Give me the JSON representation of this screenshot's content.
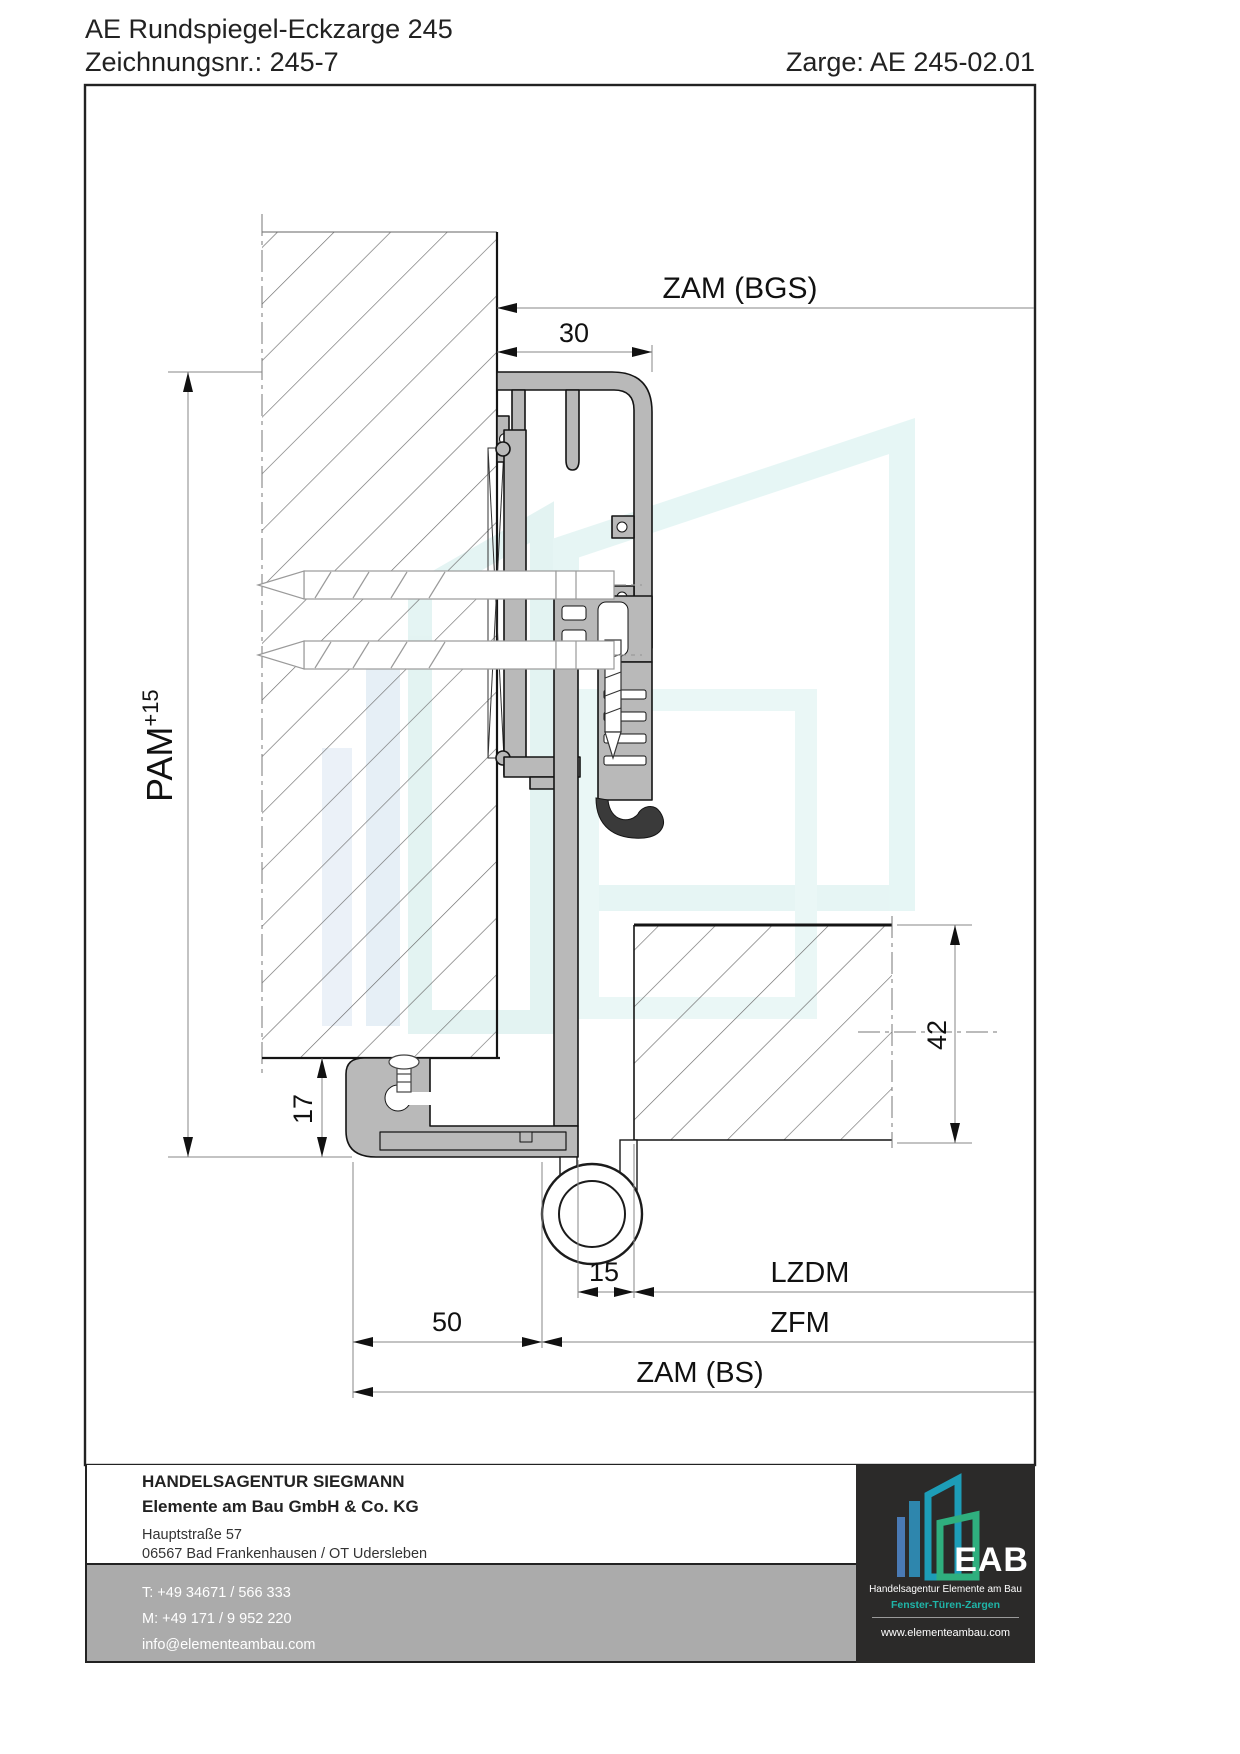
{
  "header": {
    "title": "AE Rundspiegel-Eckzarge 245",
    "drawing_number": "Zeichnungsnr.: 245-7",
    "zarge_number": "Zarge: AE 245-02.01"
  },
  "dimensions": {
    "zam_bgs": "ZAM (BGS)",
    "width_30": "30",
    "pam_label": "PAM",
    "pam_tolerance": "+15",
    "height_17": "17",
    "height_42": "42",
    "width_15": "15",
    "lzdm": "LZDM",
    "width_50": "50",
    "zfm": "ZFM",
    "zam_bs": "ZAM (BS)"
  },
  "footer": {
    "company_line1": "HANDELSAGENTUR SIEGMANN",
    "company_line2": "Elemente am Bau GmbH & Co. KG",
    "address_line1": "Hauptstraße 57",
    "address_line2": "06567 Bad Frankenhausen / OT Udersleben",
    "phone": "T: +49 34671 / 566 333",
    "mobile": "M: +49 171 / 9 952 220",
    "email": "info@elementeambau.com",
    "logo": {
      "text": "EAB",
      "subtitle": "Handelsagentur Elemente am Bau",
      "tagline": "Fenster-Türen-Zargen",
      "website": "www.elementeambau.com"
    }
  },
  "colors": {
    "profile_fill": "#b9b9b9",
    "line_dark": "#141414",
    "hatch_gray": "#6e6e6e",
    "band_gray": "#ababab",
    "logo_background": "#2b2a29",
    "logo_teal": "#1d9db8",
    "logo_green": "#2faf7e",
    "logo_blue": "#4a7ab5",
    "watermark_teal": "#d2eeec"
  }
}
